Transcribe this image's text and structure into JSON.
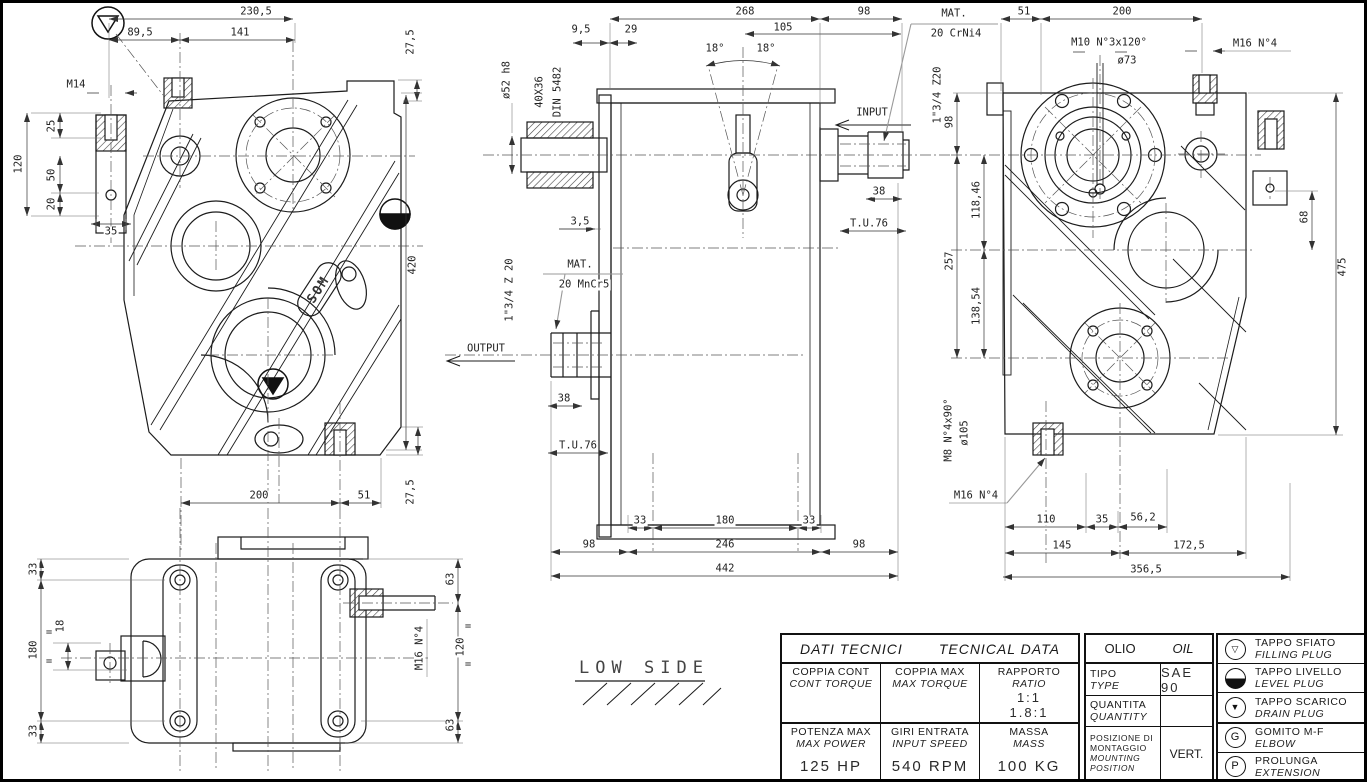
{
  "sheet": {
    "background": "#ffffff",
    "line_color": "#1a1a1a",
    "border_color": "#000000"
  },
  "labels": {
    "brand": "SOM",
    "low_side": "LOW SIDE",
    "input": "INPUT",
    "output": "OUTPUT",
    "mat": "MAT.",
    "mat_input": "20 CrNi4",
    "mat_output": "20 MnCr5"
  },
  "front": {
    "dims": {
      "width_total": "230,5",
      "width_left": "89,5",
      "width_right": "141",
      "lug_top": "27,5",
      "thread": "M14",
      "depth25": "25",
      "h120": "120",
      "h50": "50",
      "h20": "20",
      "w35": "35",
      "height_total": "420",
      "lug_bottom": "27,5",
      "base200": "200",
      "base51": "51"
    }
  },
  "side": {
    "dims": {
      "body268": "268",
      "in98": "98",
      "p95": "9,5",
      "p29": "29",
      "d105": "105",
      "angle_left": "18°",
      "angle_right": "18°",
      "dia52": "ø52 h8",
      "spline": "40X36",
      "din": "DIN 5482",
      "p35": "3,5",
      "in_spline": "1\"3/4 Z20",
      "in38": "38",
      "in_tu": "T.U.76",
      "out_spline": "1\"3/4 Z 20",
      "out38": "38",
      "out_tu": "T.U.76",
      "b33l": "33",
      "b180": "180",
      "b33r": "33",
      "b98l": "98",
      "b246": "246",
      "b98r": "98",
      "b442": "442"
    }
  },
  "end": {
    "dims": {
      "t51": "51",
      "t200": "200",
      "m10": "M10 N°3x120°",
      "dia73": "ø73",
      "m16_top": "M16 N°4",
      "v98": "98",
      "v118": "118,46",
      "v257": "257",
      "v138": "138,54",
      "v68": "68",
      "v475": "475",
      "m8": "M8 N°4x90°",
      "dia105": "ø105",
      "m16_bot": "M16 N°4",
      "b110": "110",
      "b35": "35",
      "b56": "56,2",
      "b145": "145",
      "b172": "172,5",
      "b356": "356,5"
    }
  },
  "top": {
    "dims": {
      "l33t": "33",
      "l180": "180",
      "l33b": "33",
      "d18": "18",
      "eq": "=",
      "r63t": "63",
      "r120": "120",
      "r63b": "63",
      "m16": "M16 N°4"
    }
  },
  "table": {
    "title_it": "DATI TECNICI",
    "title_en": "TECNICAL DATA",
    "oil_it": "OLIO",
    "oil_en": "OIL",
    "coppia_cont_it": "COPPIA CONT",
    "coppia_cont_en": "CONT TORQUE",
    "coppia_max_it": "COPPIA MAX",
    "coppia_max_en": "MAX TORQUE",
    "rapporto_it": "RAPPORTO",
    "rapporto_en": "RATIO",
    "ratio1": "1:1",
    "ratio2": "1.8:1",
    "tipo_it": "TIPO",
    "tipo_en": "TYPE",
    "oil_type": "SAE 90",
    "quantita_it": "QUANTITA",
    "quantita_en": "QUANTITY",
    "oil_qty": "",
    "potenza_it": "POTENZA MAX",
    "potenza_en": "MAX POWER",
    "potenza_val": "125 HP",
    "giri_it": "GIRI ENTRATA",
    "giri_en": "INPUT SPEED",
    "giri_val": "540 RPM",
    "massa_it": "MASSA",
    "massa_en": "MASS",
    "massa_val": "100 KG",
    "pos_it": "POSIZIONE DI MONTAGGIO",
    "pos_en": "MOUNTING POSITION",
    "pos_val": "VERT."
  },
  "legend": {
    "items": [
      {
        "icon": "breather-plug-icon",
        "glyph": "▽",
        "it": "TAPPO SFIATO",
        "en": "FILLING PLUG"
      },
      {
        "icon": "level-plug-icon",
        "glyph": "",
        "it": "TAPPO LIVELLO",
        "en": "LEVEL PLUG"
      },
      {
        "icon": "drain-plug-icon",
        "glyph": "▼",
        "it": "TAPPO SCARICO",
        "en": "DRAIN PLUG"
      },
      {
        "icon": "elbow-icon",
        "glyph": "G",
        "it": "GOMITO M-F",
        "en": "ELBOW"
      },
      {
        "icon": "extension-icon",
        "glyph": "P",
        "it": "PROLUNGA",
        "en": "EXTENSION"
      }
    ]
  }
}
